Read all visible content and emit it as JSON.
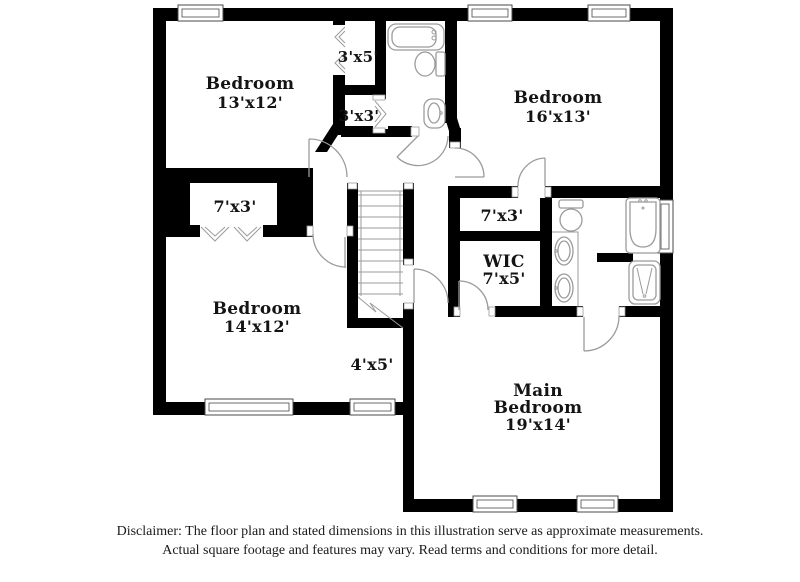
{
  "floor_plan": {
    "rooms": {
      "bedroom_top_left": {
        "name": "Bedroom",
        "dims": "13'x12'"
      },
      "bedroom_top_right": {
        "name": "Bedroom",
        "dims": "16'x13'"
      },
      "bedroom_bottom_left": {
        "name": "Bedroom",
        "dims": "14'x12'"
      },
      "main_bedroom": {
        "name_line1": "Main",
        "name_line2": "Bedroom",
        "dims": "19'x14'"
      },
      "wic": {
        "name": "WIC",
        "dims": "7'x5'"
      },
      "closet_3x5": {
        "dims": "3'x5'"
      },
      "closet_3x3": {
        "dims": "3'x3'"
      },
      "closet_left_7x3": {
        "dims": "7'x3'"
      },
      "closet_right_7x3": {
        "dims": "7'x3'"
      },
      "stair_nook": {
        "dims": "4'x5'"
      }
    },
    "features": [
      "staircase",
      "bathtub",
      "toilet",
      "sink",
      "double-vanity",
      "corner-bathtub",
      "shower",
      "windows",
      "door-swings",
      "bifold-doors"
    ]
  },
  "disclaimer": {
    "line1": "Disclaimer: The floor plan and stated dimensions in this illustration serve as approximate measurements.",
    "line2": "Actual square footage and features may vary. Read terms and conditions for more detail."
  },
  "colors": {
    "wall": "#000000",
    "background": "#ffffff",
    "fixture_line": "#9b9b9b",
    "window_line": "#4a4a4a",
    "text": "#141414"
  }
}
